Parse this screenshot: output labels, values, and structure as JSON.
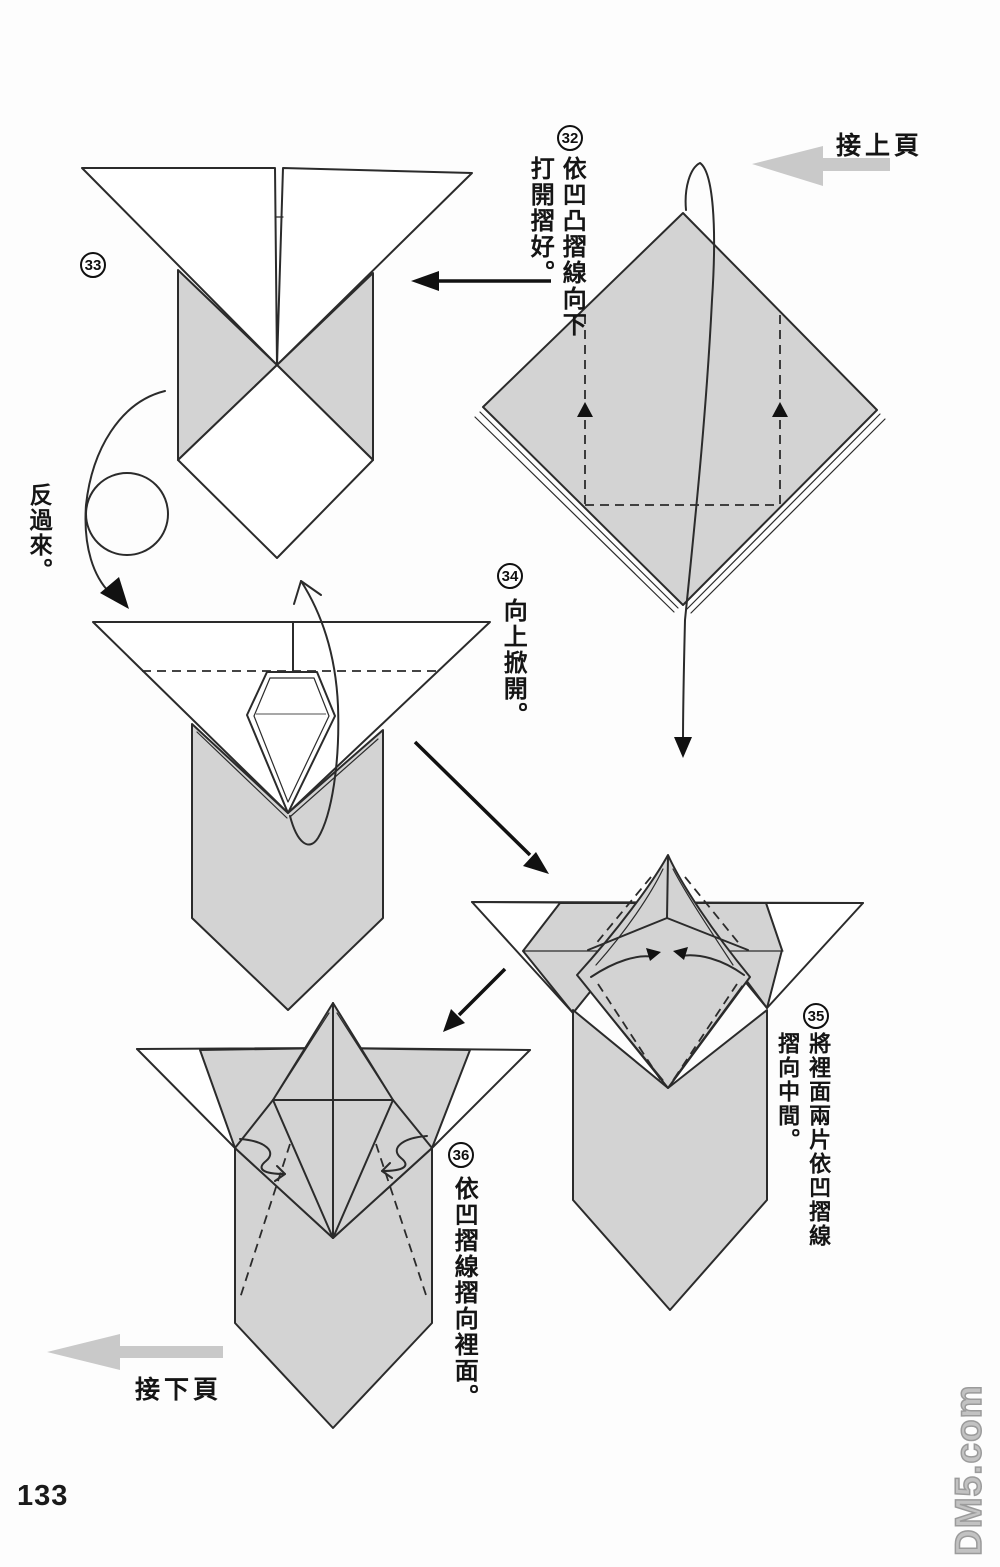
{
  "page": {
    "number": "133",
    "watermark_text": "DM5.com",
    "background_color": "#fdfdfd"
  },
  "nav": {
    "prev_label": "接上頁",
    "next_label": "接下頁"
  },
  "flip_note": "反過來。",
  "steps": [
    {
      "number": "32",
      "instruction_lines": [
        "依凹凸摺線向下",
        "打開摺好。"
      ]
    },
    {
      "number": "33",
      "instruction_lines": []
    },
    {
      "number": "34",
      "instruction_lines": [
        "向上掀開。"
      ]
    },
    {
      "number": "35",
      "instruction_lines": [
        "將裡面兩片依凹摺線",
        "摺向中間。"
      ]
    },
    {
      "number": "36",
      "instruction_lines": [
        "依凹摺線摺向裡面。"
      ]
    }
  ],
  "icons": {
    "prev_page_arrow": "gray-left-arrow",
    "next_page_arrow": "gray-left-arrow",
    "flip_symbol": "circle-with-curved-arrow",
    "step_arrows": "black-fold-direction-arrows"
  },
  "colors": {
    "paper_fill": "#d3d3d3",
    "outline": "#2b2b2b",
    "nav_arrow": "#c9c9c9",
    "watermark": "#b0b0b0",
    "text": "#151515"
  }
}
